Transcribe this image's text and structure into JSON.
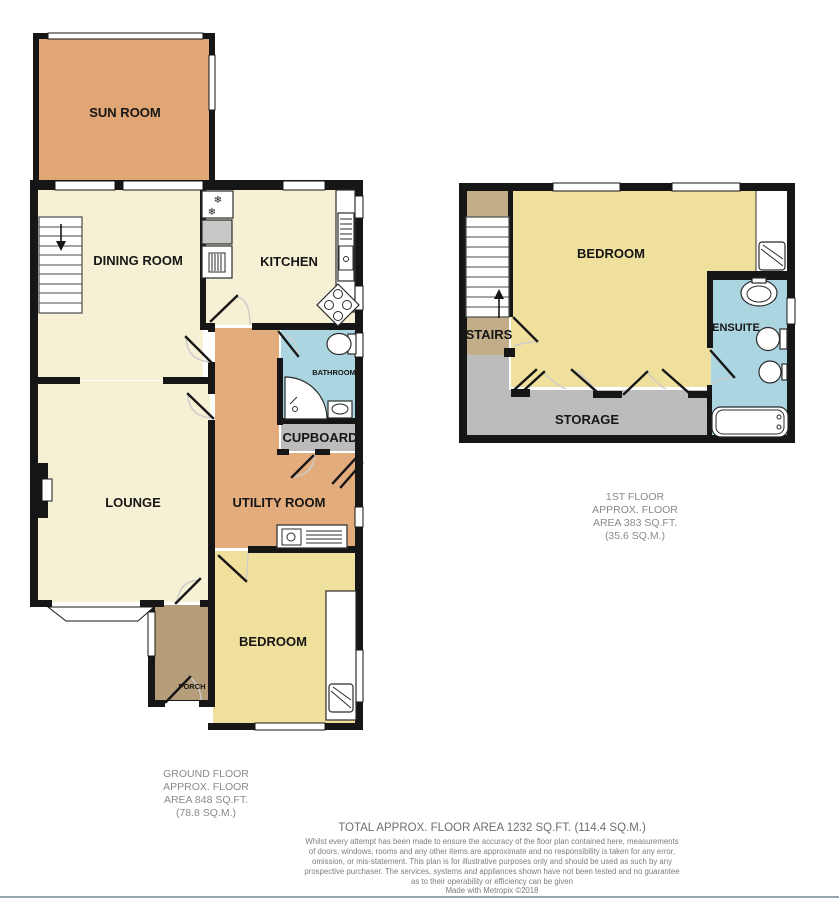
{
  "colors": {
    "wall": "#161616",
    "sun_room": "#e1a676",
    "hall_utility": "#e3ac7d",
    "cream": "#f6f0d4",
    "bedroom_yellow": "#f0e09d",
    "bath_blue": "#aad5e1",
    "storage_gray": "#bcbcbc",
    "porch_brown": "#b49d78",
    "stairs_tan": "#c3ad88",
    "appliance_gray": "#c8c8c8",
    "door_arc": "#cccccc",
    "caption_gray": "#8a8a8a",
    "total_gray": "#6e6e6e",
    "bottom_rule": "#9aa6ae"
  },
  "ground_floor": {
    "rooms": {
      "sun_room": "SUN ROOM",
      "dining_room": "DINING ROOM",
      "kitchen": "KITCHEN",
      "lounge": "LOUNGE",
      "utility_room": "UTILITY ROOM",
      "bathroom": "BATHROOM",
      "cupboard": "CUPBOARD",
      "bedroom": "BEDROOM",
      "porch": "PORCH"
    },
    "caption": [
      "GROUND FLOOR",
      "APPROX. FLOOR",
      "AREA 848 SQ.FT.",
      "(78.8 SQ.M.)"
    ]
  },
  "first_floor": {
    "rooms": {
      "bedroom": "BEDROOM",
      "stairs": "STAIRS",
      "ensuite": "ENSUITE",
      "storage": "STORAGE"
    },
    "caption": [
      "1ST FLOOR",
      "APPROX. FLOOR",
      "AREA 383 SQ.FT.",
      "(35.6 SQ.M.)"
    ]
  },
  "footer": {
    "total": "TOTAL APPROX. FLOOR AREA 1232 SQ.FT. (114.4 SQ.M.)",
    "disclaimer": [
      "Whilst every attempt has been made to ensure the accuracy of the floor plan contained here, measurements",
      "of doors, windows, rooms and any other items are approximate and no responsibility is taken for any error,",
      "omission, or mis-statement. This plan is for illustrative purposes only and should be used as such by any",
      "prospective purchaser. The services, systems and appliances shown have not been tested and no guarantee",
      "as to their operability or efficiency can be given"
    ],
    "credit": "Made with Metropix ©2018"
  }
}
